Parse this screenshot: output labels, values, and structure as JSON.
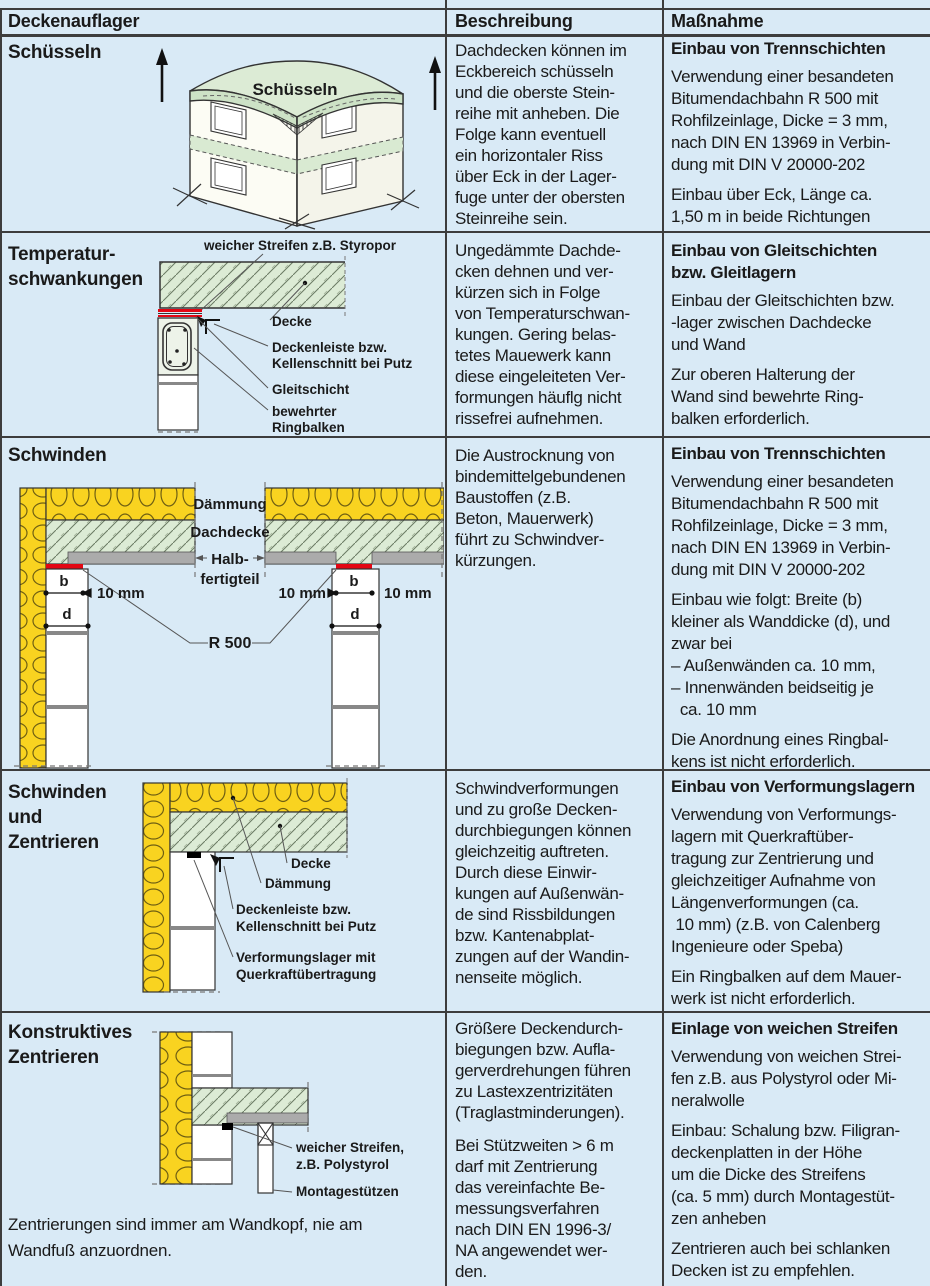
{
  "header": {
    "col1": "Deckenauflager",
    "col2": "Beschreibung",
    "col3": "Maßnahme"
  },
  "colors": {
    "background": "#d9eaf6",
    "grid_line": "#3d3d3d",
    "text": "#1a1a1a",
    "accent_red": "#e30613",
    "insulation_yellow": "#f9d320",
    "concrete_green": "#dcebd5",
    "element_gray": "#ababab"
  },
  "rows": [
    {
      "title": "Schüsseln",
      "beschreibung": [
        "Dachdecken können im\nEckbereich schüsseln\nund die oberste Stein-\nreihe mit anheben. Die\nFolge kann eventuell\nein horizontaler Riss\nüber Eck in der Lager-\nfuge unter der obersten\nSteinreihe sein."
      ],
      "massnahme": {
        "heading": "Einbau von Trennschichten",
        "paras": [
          "Verwendung einer besandeten\nBitumendachbahn R 500 mit\nRohfilzeinlage, Dicke = 3 mm,\nnach DIN EN 13969 in Verbin-\ndung mit DIN V 20000-202",
          "Einbau über Eck, Länge ca.\n1,50 m in beide Richtungen"
        ]
      },
      "diagram": {
        "label": "Schüsseln"
      }
    },
    {
      "title": "Temperatur-\nschwankungen",
      "beschreibung": [
        "Ungedämmte Dachde-\ncken dehnen und ver-\nkürzen sich in Folge\nvon Temperaturschwan-\nkungen. Gering belas-\ntetes Mauewerk kann\ndiese eingeleiteten Ver-\nformungen häuflg nicht\nrissefrei aufnehmen."
      ],
      "massnahme": {
        "heading": "Einbau von Gleitschichten\nbzw. Gleitlagern",
        "paras": [
          "Einbau der Gleitschichten bzw.\n-lager zwischen Dachdecke\nund Wand",
          "Zur oberen Halterung der\nWand sind bewehrte Ring-\nbalken erforderlich."
        ]
      },
      "diagram": {
        "top_label": "weicher Streifen z.B. Styropor",
        "decke": "Decke",
        "leiste1": "Deckenleiste bzw.",
        "leiste2": "Kellenschnitt bei Putz",
        "gleitschicht": "Gleitschicht",
        "ringbalken1": "bewehrter",
        "ringbalken2": "Ringbalken"
      }
    },
    {
      "title": "Schwinden",
      "beschreibung": [
        "Die Austrocknung von\nbindemittelgebundenen\nBaustoffen (z.B.\nBeton, Mauerwerk)\nführt zu Schwindver-\nkürzungen."
      ],
      "massnahme": {
        "heading": "Einbau von Trennschichten",
        "paras": [
          "Verwendung einer besandeten\nBitumendachbahn R 500 mit\nRohfilzeinlage, Dicke = 3 mm,\nnach DIN EN 13969 in Verbin-\ndung mit DIN V 20000-202",
          "Einbau wie folgt: Breite (b)\nkleiner als Wanddicke (d), und\nzwar bei\n– Außenwänden ca. 10 mm,\n– Innenwänden beidseitig je\n  ca. 10 mm",
          "Die Anordnung eines Ringbal-\nkens ist nicht erforderlich."
        ]
      },
      "diagram": {
        "daemmung": "Dämmung",
        "dachdecke": "Dachdecke",
        "halb1": "Halb-",
        "halb2": "fertigteil",
        "dim_b": "b",
        "dim_d": "d",
        "mm10": "10 mm",
        "r500": "R 500"
      }
    },
    {
      "title": "Schwinden\nund\nZentrieren",
      "beschreibung": [
        "Schwindverformungen\nund zu große Decken-\ndurchbiegungen können\ngleichzeitig auftreten.\nDurch diese Einwir-\nkungen auf Außenwän-\nde sind Rissbildungen\nbzw. Kantenabplat-\nzungen auf der Wandin-\nnenseite möglich."
      ],
      "massnahme": {
        "heading": "Einbau von Verformungslagern",
        "paras": [
          "Verwendung von Verformungs-\nlagern mit Querkraftüber-\ntragung zur Zentrierung und\ngleichzeitiger Aufnahme von\nLängenverformungen (ca.\n 10 mm) (z.B. von Calenberg\nIngenieure oder Speba)",
          "Ein Ringbalken auf dem Mauer-\nwerk ist nicht erforderlich."
        ]
      },
      "diagram": {
        "decke": "Decke",
        "daemmung": "Dämmung",
        "leiste1": "Deckenleiste bzw.",
        "leiste2": "Kellenschnitt bei Putz",
        "lager1": "Verformungslager mit",
        "lager2": "Querkraftübertragung"
      }
    },
    {
      "title": "Konstruktives\nZentrieren",
      "beschreibung": [
        "Größere Deckendurch-\nbiegungen bzw. Aufla-\ngerverdrehungen führen\nzu Lastexzentrizitäten\n(Traglastminderungen).",
        "Bei Stützweiten > 6 m\ndarf mit Zentrierung\ndas vereinfachte Be-\nmessungsverfahren\nnach DIN EN 1996-3/\nNA angewendet wer-\nden."
      ],
      "massnahme": {
        "heading": "Einlage von weichen Streifen",
        "paras": [
          "Verwendung von weichen Strei-\nfen z.B. aus Polystyrol oder Mi-\nneralwolle",
          "Einbau: Schalung bzw. Filigran-\ndeckenplatten in der Höhe\num die Dicke des Streifens\n(ca. 5 mm) durch Montagestüt-\nzen anheben",
          "Zentrieren auch bei schlanken\nDecken ist zu empfehlen."
        ]
      },
      "footnote": "Zentrierungen sind immer am Wandkopf, nie am\nWandfuß anzuordnen.",
      "diagram": {
        "streifen1": "weicher Streifen,",
        "streifen2": "z.B. Polystyrol",
        "stuetzen": "Montagestützen"
      }
    }
  ]
}
